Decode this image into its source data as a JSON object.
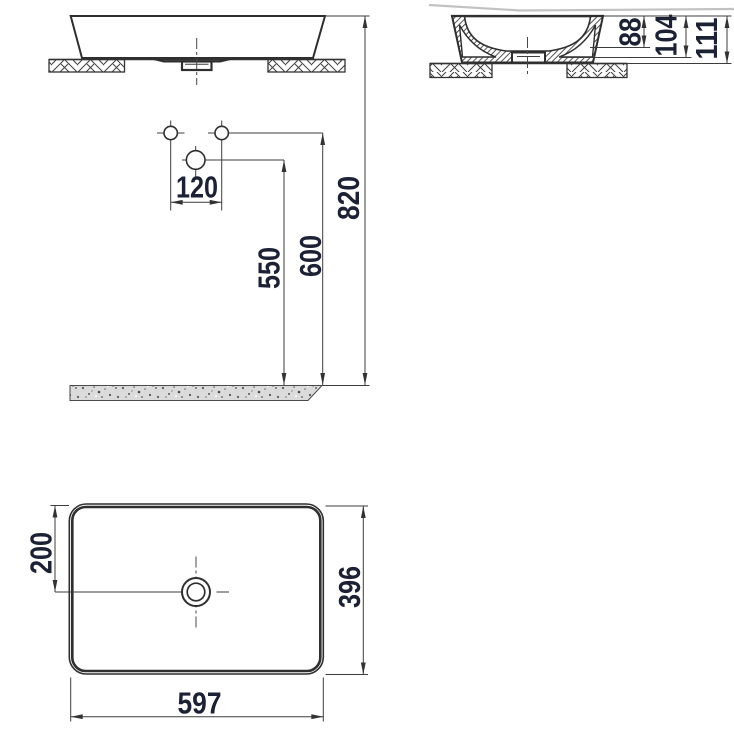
{
  "colors": {
    "line": "#2f2f2f",
    "dim_text": "#1c2133",
    "floor_fill": "#dbdbdb",
    "artifact_gray": "#c2c2c2"
  },
  "views": {
    "front": {
      "hole_spacing": "120",
      "drain_center_height": "550",
      "holes_height": "600",
      "rim_height": "820"
    },
    "section": {
      "inner_depth": "88",
      "mid_height": "104",
      "total_height": "111"
    },
    "plan": {
      "drain_offset": "200",
      "depth": "396",
      "width": "597"
    }
  }
}
